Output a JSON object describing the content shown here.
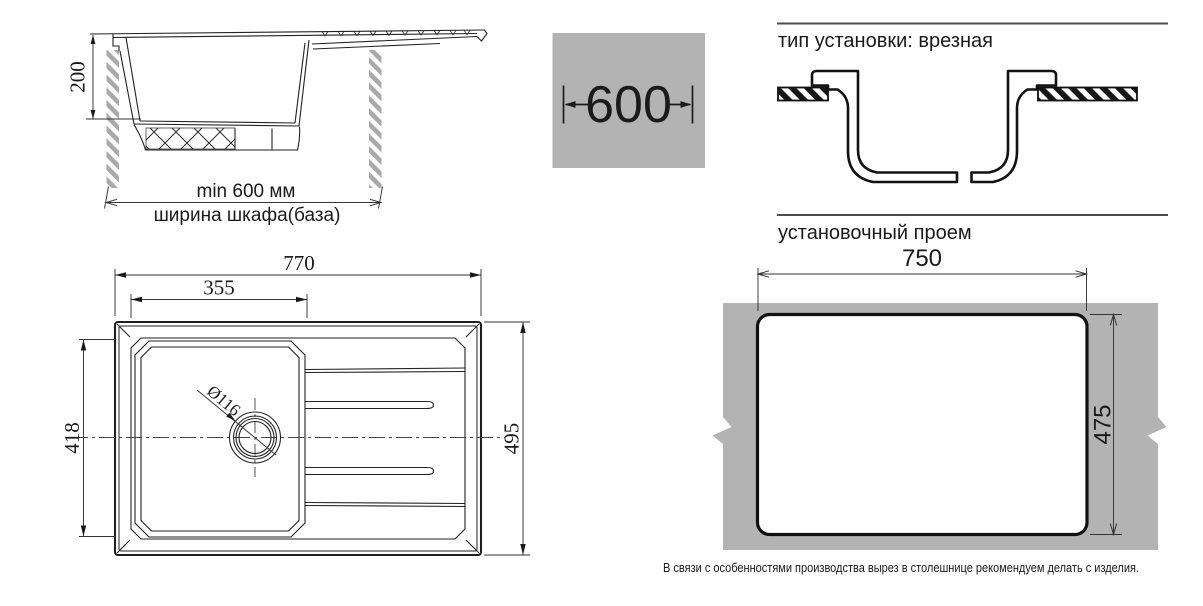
{
  "side_view": {
    "height_dim": "200",
    "min_width_label": "min 600 мм",
    "cabinet_label": "ширина шкафа(база)"
  },
  "cabinet_width_badge": {
    "value": "600"
  },
  "installation": {
    "type_title": "тип установки: врезная",
    "opening_title": "установочный проем",
    "opening_width": "750",
    "opening_height": "475",
    "note": "В связи с особенностями производства вырез в столешнице рекомендуем делать с изделия."
  },
  "top_view": {
    "overall_width": "770",
    "bowl_width": "355",
    "bowl_depth_dim": "418",
    "overall_depth": "495",
    "drain_diameter": "Ø116"
  },
  "colors": {
    "surface_gray": "#b3b3b3",
    "line": "#1f1f1f",
    "rule": "#4d4d4d"
  }
}
